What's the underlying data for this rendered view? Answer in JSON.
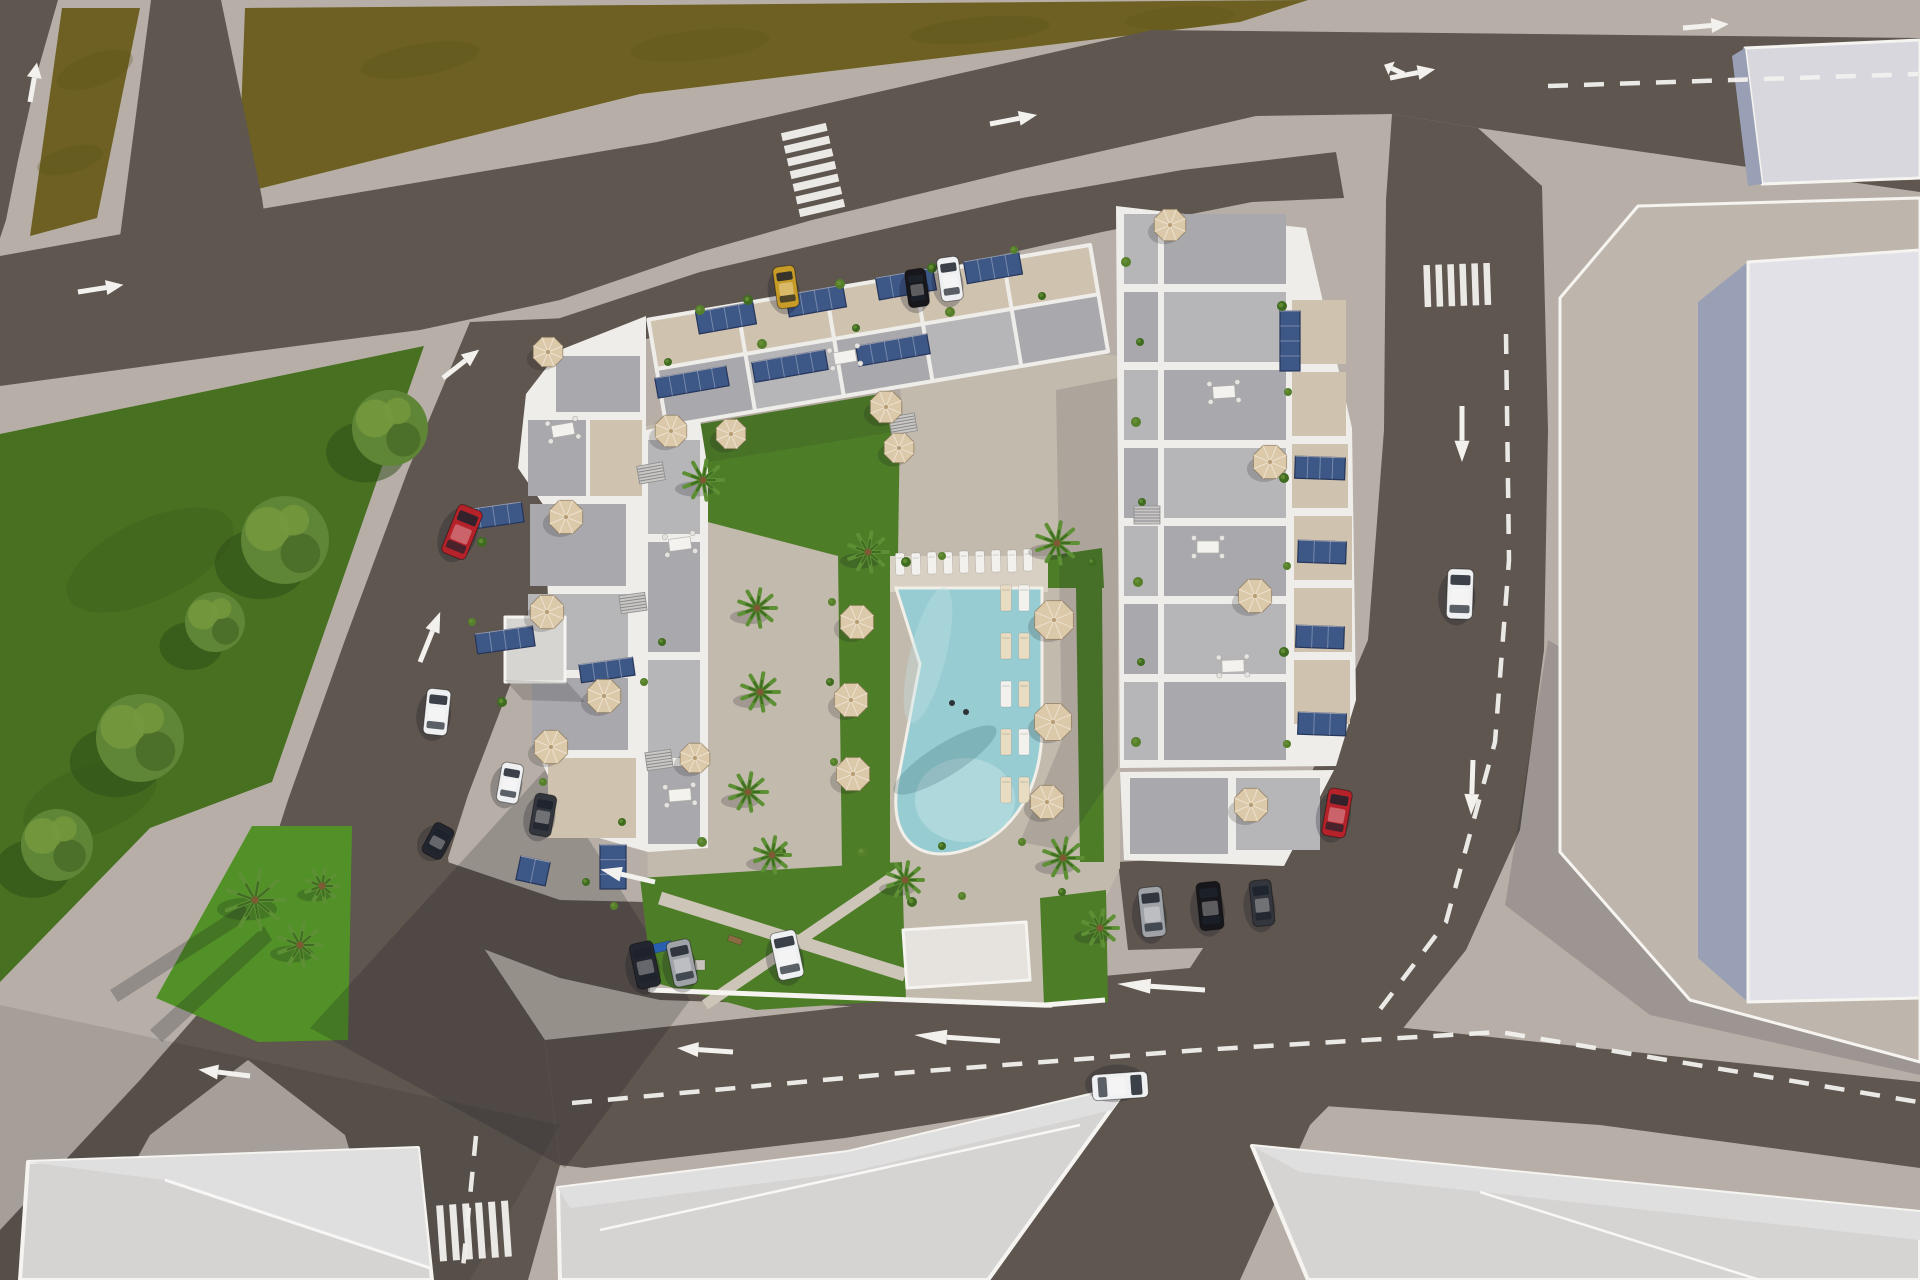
{
  "meta": {
    "type": "aerial-3d-architectural-render",
    "description": "Top-down 3D rendering of a residential apartment complex with rooftop terraces, solar panels and a central courtyard with swimming pool, lawns, palm trees and parasols; surrounded by asphalt roads with white lane markings, crosswalks and cars, an olive field to the north-west, a green park to the west and large neighbouring buildings to the east and south.",
    "width": 1920,
    "height": 1280
  },
  "colors": {
    "sidewalk": "#b7afa7",
    "road": "#5e564f",
    "field": "#6d6022",
    "field_dark": "#584e17",
    "park": "#477020",
    "park_dark": "#2c4b16",
    "island": "#529127",
    "tree": "#5f8536",
    "tree_light": "#74983d",
    "tree_dark": "#4a6d28",
    "palm": "#5d8f35",
    "palm_dark": "#3f6b22",
    "paving": "#c3baae",
    "deck": "#d8d0c2",
    "lawn": "#4e7d28",
    "path": "#cdc5b8",
    "pool": "#97ccd2",
    "pool_light": "#c2e2e4",
    "wall": "#efede9",
    "terrace": "#a9a8ac",
    "terrace_light": "#b6b5b8",
    "beige": "#cfc3b0",
    "solar": "#3d5787",
    "solar_dark": "#26355a",
    "umbrella": "#dcc9a9",
    "umbrella_dark": "#b59c74",
    "marking": "#f2f1ee",
    "neighbor_plot": "#beb6ac",
    "neighbor_top": "#e2e1e7",
    "neighbor_side": "#99a0b5",
    "neighbor_block": "#d8d7dd",
    "bottom_roof": "#d6d4d3",
    "bottom_roof_light": "#e0dfdf",
    "bottom_roof_dark": "#c8c6c6",
    "shed": "#d7d5d2",
    "structure": "#e6e3de",
    "car_red": "#b5222a",
    "car_yellow": "#c79b27",
    "car_black": "#17171b",
    "car_white": "#eff0f1",
    "car_silver": "#9fa3a8",
    "car_gray": "#33363c",
    "car_darkblue": "#23262e"
  },
  "objects": {
    "cars": [
      {
        "name": "red-car-left-road",
        "color": "car_red",
        "x": 462,
        "y": 532,
        "w": 26,
        "h": 52,
        "rot": 22
      },
      {
        "name": "red-car-right-road",
        "color": "car_red",
        "x": 1337,
        "y": 813,
        "w": 24,
        "h": 48,
        "rot": 10
      },
      {
        "name": "white-car-right-road",
        "color": "car_white",
        "x": 1460,
        "y": 594,
        "w": 26,
        "h": 50,
        "rot": 2
      },
      {
        "name": "white-car-bottom-road",
        "color": "car_white",
        "x": 1120,
        "y": 1086,
        "w": 26,
        "h": 56,
        "rot": 86
      },
      {
        "name": "yellow-car-parked-top",
        "color": "car_yellow",
        "x": 786,
        "y": 287,
        "w": 22,
        "h": 42,
        "rot": -8
      },
      {
        "name": "black-car-parked-top",
        "color": "car_black",
        "x": 917,
        "y": 288,
        "w": 21,
        "h": 38,
        "rot": -8
      },
      {
        "name": "white-car-parked-top",
        "color": "car_white",
        "x": 950,
        "y": 279,
        "w": 22,
        "h": 44,
        "rot": -8
      },
      {
        "name": "darkblue-car-parked-south",
        "color": "car_darkblue",
        "x": 645,
        "y": 965,
        "w": 24,
        "h": 46,
        "rot": -12
      },
      {
        "name": "silver-car-parked-south",
        "color": "car_silver",
        "x": 682,
        "y": 963,
        "w": 24,
        "h": 46,
        "rot": -12
      },
      {
        "name": "white-car-parked-south",
        "color": "car_white",
        "x": 787,
        "y": 955,
        "w": 26,
        "h": 48,
        "rot": -12
      },
      {
        "name": "white-car-parked-west",
        "color": "car_white",
        "x": 437,
        "y": 712,
        "w": 24,
        "h": 46,
        "rot": 6
      },
      {
        "name": "white-car-parked-southwest",
        "color": "car_white",
        "x": 510,
        "y": 783,
        "w": 22,
        "h": 40,
        "rot": 10
      },
      {
        "name": "gray-car-parked-southwest",
        "color": "car_gray",
        "x": 543,
        "y": 815,
        "w": 22,
        "h": 42,
        "rot": 10
      },
      {
        "name": "silver-car-parked-east",
        "color": "car_silver",
        "x": 1152,
        "y": 912,
        "w": 24,
        "h": 50,
        "rot": -6
      },
      {
        "name": "black-car-parked-east",
        "color": "car_black",
        "x": 1210,
        "y": 906,
        "w": 24,
        "h": 48,
        "rot": -6
      },
      {
        "name": "gray-car-parked-east",
        "color": "car_gray",
        "x": 1262,
        "y": 903,
        "w": 22,
        "h": 46,
        "rot": -6
      },
      {
        "name": "dark-car-west-junction",
        "color": "car_darkblue",
        "x": 438,
        "y": 841,
        "w": 22,
        "h": 34,
        "rot": 28
      }
    ],
    "arrows": [
      {
        "name": "arrow-left-edge-up",
        "x": 30,
        "y": 102,
        "angle": -80,
        "len": 40
      },
      {
        "name": "arrow-left-road-right",
        "x": 78,
        "y": 292,
        "angle": -9,
        "len": 46
      },
      {
        "name": "arrow-diagonal-up-1",
        "x": 443,
        "y": 378,
        "angle": -38,
        "len": 46
      },
      {
        "name": "arrow-diagonal-up-2",
        "x": 420,
        "y": 662,
        "angle": -68,
        "len": 54
      },
      {
        "name": "arrow-top-road-right-1",
        "x": 990,
        "y": 124,
        "angle": -11,
        "len": 48
      },
      {
        "name": "arrow-top-road-right-2",
        "x": 1683,
        "y": 28,
        "angle": -5,
        "len": 46
      },
      {
        "name": "arrow-top-road-fork",
        "x": 1390,
        "y": 78,
        "angle": -11,
        "len": 46
      },
      {
        "name": "arrow-top-road-fork-branch",
        "x": 1404,
        "y": 74,
        "angle": 205,
        "len": 22
      },
      {
        "name": "arrow-right-road-down-1",
        "x": 1462,
        "y": 406,
        "angle": 90,
        "len": 56
      },
      {
        "name": "arrow-right-road-down-2",
        "x": 1473,
        "y": 760,
        "angle": 92,
        "len": 55
      },
      {
        "name": "arrow-bottom-road-left-1",
        "x": 1205,
        "y": 990,
        "angle": 184,
        "len": 88
      },
      {
        "name": "arrow-bottom-road-left-2",
        "x": 1000,
        "y": 1041,
        "angle": 184,
        "len": 86
      },
      {
        "name": "arrow-bottom-road-left-3",
        "x": 733,
        "y": 1052,
        "angle": 184,
        "len": 56
      },
      {
        "name": "arrow-junction-left",
        "x": 655,
        "y": 882,
        "angle": 193,
        "len": 56
      },
      {
        "name": "arrow-southwest-left",
        "x": 250,
        "y": 1076,
        "angle": 187,
        "len": 52
      }
    ],
    "dash_lines": [
      {
        "name": "top-road-dashes",
        "pts": [
          [
            1548,
            86
          ],
          [
            1918,
            74
          ]
        ]
      },
      {
        "name": "right-road-dashes",
        "pts": [
          [
            1506,
            334
          ],
          [
            1509,
            560
          ],
          [
            1495,
            742
          ],
          [
            1446,
            922
          ],
          [
            1372,
            1020
          ]
        ]
      },
      {
        "name": "bottom-road-dashes",
        "pts": [
          [
            572,
            1103
          ],
          [
            900,
            1073
          ],
          [
            1200,
            1050
          ],
          [
            1500,
            1032
          ],
          [
            1918,
            1102
          ]
        ]
      },
      {
        "name": "southwest-road-dashes",
        "pts": [
          [
            476,
            1136
          ],
          [
            462,
            1278
          ]
        ]
      }
    ],
    "crosswalks": [
      {
        "name": "crosswalk-top",
        "x": 790,
        "y": 127,
        "bars": 7,
        "barW": 46,
        "barH": 8,
        "gap": 5,
        "rot": -13,
        "horizontal": true
      },
      {
        "name": "crosswalk-right-road",
        "x": 1424,
        "y": 264,
        "bars": 6,
        "barW": 6.5,
        "barH": 42,
        "gap": 5.5,
        "rot": -2,
        "horizontal": false
      },
      {
        "name": "crosswalk-southwest",
        "x": 438,
        "y": 1203,
        "bars": 6,
        "barW": 7,
        "barH": 56,
        "gap": 6,
        "rot": -4,
        "horizontal": false
      }
    ],
    "umbrellas": [
      [
        548,
        352,
        16
      ],
      [
        671,
        431,
        17
      ],
      [
        731,
        434,
        16
      ],
      [
        886,
        407,
        17
      ],
      [
        899,
        448,
        16
      ],
      [
        566,
        517,
        18
      ],
      [
        547,
        612,
        18
      ],
      [
        604,
        696,
        18
      ],
      [
        551,
        747,
        18
      ],
      [
        695,
        758,
        16
      ],
      [
        857,
        622,
        18
      ],
      [
        851,
        700,
        18
      ],
      [
        853,
        774,
        18
      ],
      [
        1054,
        620,
        21
      ],
      [
        1053,
        722,
        20
      ],
      [
        1047,
        802,
        18
      ],
      [
        1170,
        225,
        17
      ],
      [
        1270,
        462,
        18
      ],
      [
        1255,
        596,
        18
      ],
      [
        1251,
        805,
        18
      ]
    ],
    "palms": [
      [
        703,
        480,
        20
      ],
      [
        868,
        552,
        20
      ],
      [
        757,
        608,
        19
      ],
      [
        760,
        692,
        19
      ],
      [
        748,
        792,
        19
      ],
      [
        772,
        855,
        18
      ],
      [
        1057,
        543,
        21
      ],
      [
        1063,
        858,
        20
      ],
      [
        905,
        880,
        18
      ],
      [
        1100,
        928,
        18
      ],
      [
        255,
        900,
        30
      ],
      [
        300,
        945,
        22
      ],
      [
        322,
        886,
        17
      ]
    ],
    "park_trees": [
      [
        390,
        428,
        38
      ],
      [
        285,
        540,
        44
      ],
      [
        215,
        622,
        30
      ],
      [
        140,
        738,
        44
      ],
      [
        57,
        845,
        36
      ]
    ],
    "solar_panels": [
      [
        726,
        318,
        58,
        22,
        -10
      ],
      [
        816,
        301,
        58,
        22,
        -10
      ],
      [
        906,
        284,
        58,
        22,
        -10
      ],
      [
        993,
        268,
        56,
        22,
        -10
      ],
      [
        692,
        382,
        72,
        20,
        -10
      ],
      [
        790,
        366,
        74,
        20,
        -10
      ],
      [
        893,
        350,
        72,
        20,
        -10
      ],
      [
        494,
        516,
        58,
        20,
        -8
      ],
      [
        505,
        640,
        58,
        20,
        -8
      ],
      [
        607,
        670,
        54,
        18,
        -8
      ],
      [
        1320,
        468,
        50,
        22,
        2
      ],
      [
        1322,
        552,
        48,
        22,
        2
      ],
      [
        1320,
        637,
        48,
        22,
        2
      ],
      [
        1322,
        724,
        48,
        22,
        2
      ],
      [
        1290,
        341,
        20,
        60,
        0
      ],
      [
        533,
        871,
        30,
        24,
        12
      ],
      [
        613,
        867,
        26,
        44,
        0
      ]
    ],
    "loungers": [
      [
        900,
        564,
        9,
        22,
        "w",
        -2
      ],
      [
        916,
        564,
        9,
        22,
        "w",
        -2
      ],
      [
        932,
        563,
        9,
        22,
        "w",
        -2
      ],
      [
        948,
        563,
        9,
        22,
        "w",
        -2
      ],
      [
        964,
        562,
        9,
        22,
        "w",
        -2
      ],
      [
        980,
        562,
        9,
        22,
        "w",
        -2
      ],
      [
        996,
        561,
        9,
        22,
        "w",
        -2
      ],
      [
        1012,
        561,
        9,
        22,
        "w",
        -2
      ],
      [
        1028,
        560,
        9,
        22,
        "w",
        -2
      ],
      [
        1006,
        598,
        11,
        26,
        "b",
        0
      ],
      [
        1024,
        598,
        11,
        26,
        "w",
        0
      ],
      [
        1006,
        646,
        11,
        26,
        "b",
        0
      ],
      [
        1024,
        646,
        11,
        26,
        "b",
        0
      ],
      [
        1006,
        694,
        11,
        26,
        "w",
        0
      ],
      [
        1024,
        694,
        11,
        26,
        "b",
        0
      ],
      [
        1006,
        742,
        11,
        26,
        "b",
        0
      ],
      [
        1024,
        742,
        11,
        26,
        "w",
        0
      ],
      [
        1006,
        790,
        11,
        26,
        "b",
        0
      ],
      [
        1024,
        790,
        11,
        26,
        "b",
        0
      ]
    ],
    "tables": [
      [
        1224,
        392,
        -4
      ],
      [
        1208,
        547,
        0
      ],
      [
        1233,
        666,
        -2
      ],
      [
        680,
        544,
        -8
      ],
      [
        680,
        795,
        -5
      ],
      [
        845,
        357,
        -10
      ],
      [
        563,
        430,
        -10
      ]
    ],
    "stairs": [
      [
        651,
        473,
        -10
      ],
      [
        633,
        603,
        -8
      ],
      [
        659,
        760,
        -8
      ],
      [
        903,
        424,
        -10
      ],
      [
        1147,
        515,
        0
      ]
    ],
    "planters": [
      [
        700,
        310,
        5
      ],
      [
        748,
        300,
        5
      ],
      [
        840,
        284,
        5
      ],
      [
        932,
        268,
        5
      ],
      [
        1014,
        250,
        4
      ],
      [
        668,
        362,
        4
      ],
      [
        762,
        344,
        5
      ],
      [
        856,
        328,
        4
      ],
      [
        950,
        312,
        5
      ],
      [
        1042,
        296,
        4
      ],
      [
        1126,
        262,
        5
      ],
      [
        1140,
        342,
        4
      ],
      [
        1136,
        422,
        5
      ],
      [
        1142,
        502,
        4
      ],
      [
        1138,
        582,
        5
      ],
      [
        1141,
        662,
        4
      ],
      [
        1136,
        742,
        5
      ],
      [
        1282,
        306,
        5
      ],
      [
        1288,
        392,
        4
      ],
      [
        1284,
        478,
        5
      ],
      [
        1287,
        566,
        4
      ],
      [
        1284,
        652,
        5
      ],
      [
        1287,
        744,
        4
      ],
      [
        482,
        542,
        5
      ],
      [
        472,
        622,
        4
      ],
      [
        502,
        702,
        5
      ],
      [
        543,
        782,
        4
      ],
      [
        622,
        822,
        4
      ],
      [
        702,
        842,
        5
      ],
      [
        782,
        852,
        4
      ],
      [
        862,
        852,
        5
      ],
      [
        942,
        846,
        4
      ],
      [
        1022,
        842,
        4
      ],
      [
        662,
        642,
        4
      ],
      [
        644,
        682,
        4
      ],
      [
        906,
        562,
        5
      ],
      [
        942,
        556,
        4
      ],
      [
        1092,
        562,
        4
      ],
      [
        832,
        602,
        4
      ],
      [
        830,
        682,
        4
      ],
      [
        834,
        762,
        4
      ],
      [
        912,
        902,
        5
      ],
      [
        962,
        896,
        4
      ],
      [
        1062,
        892,
        4
      ],
      [
        614,
        906,
        4
      ],
      [
        586,
        882,
        4
      ]
    ],
    "pool_people": [
      [
        952,
        703
      ],
      [
        966,
        712
      ]
    ],
    "playground": [
      {
        "x": 662,
        "y": 947,
        "w": 20,
        "h": 9,
        "rot": -12,
        "color": "#2a5fb0"
      },
      {
        "x": 735,
        "y": 940,
        "w": 14,
        "h": 6,
        "rot": 20,
        "color": "#8a6b44"
      },
      {
        "x": 700,
        "y": 965,
        "w": 10,
        "h": 10,
        "rot": 0,
        "color": "#c8c3ba"
      }
    ]
  }
}
